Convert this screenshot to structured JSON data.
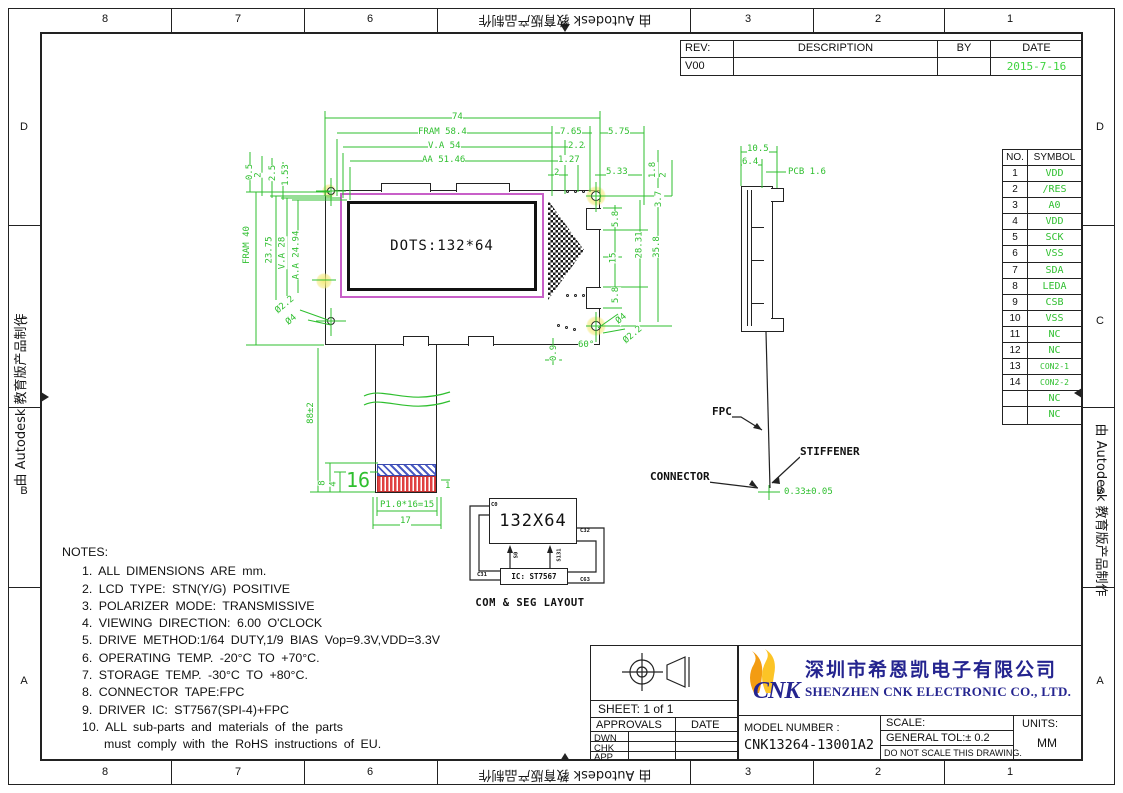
{
  "watermark": "由 Autodesk 教育版产品制作",
  "frame": {
    "cols": [
      "8",
      "7",
      "6",
      "3",
      "2",
      "1"
    ],
    "rows": [
      "D",
      "C",
      "B",
      "A"
    ]
  },
  "colors": {
    "dim_green": "#2fbf2f",
    "display_magenta": "#c85fc8",
    "contact_red": "#e04040",
    "stiffener_blue": "#4a5bc4",
    "brand_navy": "#24248f",
    "logo_orange": "#f39c12",
    "logo_gold": "#fcc426",
    "date_green": "#3fd43f"
  },
  "rev_table": {
    "headers": [
      "REV:",
      "DESCRIPTION",
      "BY",
      "DATE"
    ],
    "rev": "V00",
    "description": "",
    "by": "",
    "date": "2015-7-16"
  },
  "pin_table": {
    "headers": [
      "NO.",
      "SYMBOL"
    ],
    "rows": [
      {
        "no": "1",
        "sym": "VDD"
      },
      {
        "no": "2",
        "sym": "/RES"
      },
      {
        "no": "3",
        "sym": "A0"
      },
      {
        "no": "4",
        "sym": "VDD"
      },
      {
        "no": "5",
        "sym": "SCK"
      },
      {
        "no": "6",
        "sym": "VSS"
      },
      {
        "no": "7",
        "sym": "SDA"
      },
      {
        "no": "8",
        "sym": "LEDA"
      },
      {
        "no": "9",
        "sym": "CSB"
      },
      {
        "no": "10",
        "sym": "VSS"
      },
      {
        "no": "11",
        "sym": "NC"
      },
      {
        "no": "12",
        "sym": "NC"
      },
      {
        "no": "13",
        "sym": "CON2-1"
      },
      {
        "no": "14",
        "sym": "CON2-2"
      },
      {
        "no": "",
        "sym": "NC"
      },
      {
        "no": "",
        "sym": "NC"
      }
    ]
  },
  "front_view": {
    "display_text": "DOTS:132*64"
  },
  "dims": {
    "w74": "74",
    "fram_w": "FRAM 58.4",
    "va_w": "V.A 54",
    "aa_w": "AA 51.46",
    "d7_65": "7.65",
    "d2_2": "2.2",
    "d1_27": "1.27",
    "d2t": "2",
    "d5_75": "5.75",
    "d5_33": "5.33",
    "d1_8": "1.8",
    "d2r": "2",
    "d0_5": "0.5",
    "d2l": "2",
    "d2_5": "2.5",
    "d1_53": "1.53",
    "fram_h": "FRAM 40",
    "d23_75": "23.75",
    "va_h": "V.A 28",
    "aa_h": "A.A 24.94",
    "dia2_2l": "Ø2.2",
    "dia4l": "Ø4",
    "d3_7": "3.7",
    "d5_8a": "5.8",
    "d15": "15",
    "d5_8b": "5.8",
    "d28_31": "28.31",
    "d35_8": "35.8",
    "dia4r": "Ø4",
    "dia2_2r": "Ø2.2",
    "d60": "60°",
    "d0_9": "0.9",
    "d88": "88±2",
    "d8": "8",
    "d4": "4",
    "d16": "16",
    "d1": "1",
    "pitch": "P1.0*16=15",
    "d17": "17",
    "d10_5": "10.5",
    "d6_4": "6.4",
    "pcb": "PCB 1.6",
    "d0_33": "0.33±0.05"
  },
  "side_view": {
    "labels": {
      "fpc": "FPC",
      "stiffener": "STIFFENER",
      "connector": "CONNECTOR"
    }
  },
  "com_seg": {
    "title": "COM & SEG LAYOUT",
    "matrix": "132X64",
    "ic": "IC: ST7567",
    "labels": {
      "s0": "S0",
      "s131": "S131",
      "c0": "C0",
      "c31": "C31",
      "c32": "C32",
      "c63": "C63"
    }
  },
  "notes": {
    "title": "NOTES:",
    "items": [
      "1.  ALL DIMENSIONS ARE mm.",
      "2.  LCD TYPE: STN(Y/G) POSITIVE",
      "3.  POLARIZER MODE: TRANSMISSIVE",
      "4.  VIEWING DIRECTION: 6.00 O'CLOCK",
      "5.  DRIVE METHOD:1/64 DUTY,1/9 BIAS Vop=9.3V,VDD=3.3V",
      "6.  OPERATING TEMP. -20°C TO +70°C.",
      "7.  STORAGE TEMP. -30°C TO +80°C.",
      "8.  CONNECTOR TAPE:FPC",
      "9.  DRIVER IC: ST7567(SPI-4)+FPC",
      "10. ALL sub-parts and materials of the parts",
      "must comply with the RoHS instructions of EU."
    ]
  },
  "title_block": {
    "sheet": "SHEET:  1  of  1",
    "approvals": "APPROVALS",
    "date": "DATE",
    "rows": [
      "DWN",
      "CHK",
      "APP"
    ],
    "logo": "CNK",
    "company_cn": "深圳市希恩凯电子有限公司",
    "company_en": "SHENZHEN CNK ELECTRONIC CO., LTD.",
    "model_label": "MODEL NUMBER :",
    "model_number": "CNK13264-13001A2",
    "scale_label": "SCALE:",
    "tolerance": "GENERAL TOL:± 0.2",
    "no_scale": "DO NOT SCALE THIS DRAWING.",
    "units_label": "UNITS:",
    "units": "MM"
  }
}
